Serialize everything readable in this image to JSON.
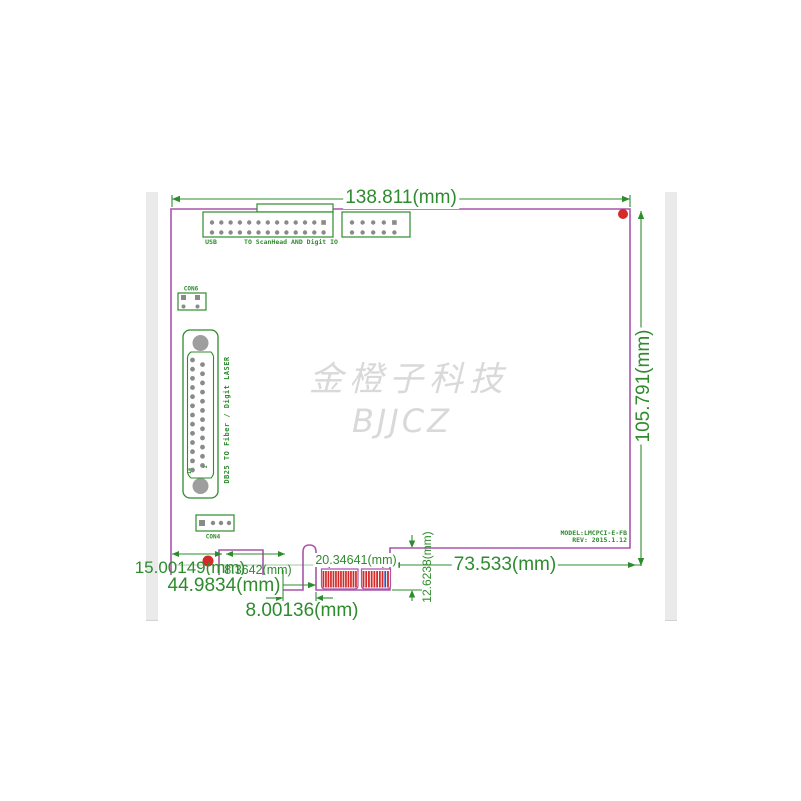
{
  "drawing": {
    "dimensions": {
      "board_width": "138.811(mm)",
      "board_height": "105.791(mm)",
      "bracket_offset": "15.00149(mm)",
      "notch_width": "8.3642(mm)",
      "edge_to_key": "44.9834(mm)",
      "key_width": "8.00136(mm)",
      "finger_span": "20.34641(mm)",
      "finger_height": "12.6238(mm)",
      "finger_to_edge": "73.533(mm)"
    },
    "labels": {
      "usb": "USB",
      "scanhead": "TO ScanHead AND Digit IO",
      "con6": "CON6",
      "con4": "CON4",
      "db25": "DB25  TO Fiber / Digit LASER",
      "model": "MODEL:LMCPCI-E-FB",
      "rev": "REV: 2015.1.12",
      "pin14": "14",
      "pin1": "1"
    },
    "watermark": {
      "line1": "金橙子科技",
      "line2": "BJJCZ"
    }
  },
  "connectors": {
    "usb_header": {
      "rows": 2,
      "pins_per_row": 13
    },
    "io_header": {
      "rows": 2,
      "pins_per_row": 5
    },
    "db25": {
      "pins_col1": 13,
      "pins_col2": 12
    },
    "con6": {
      "pins": 4
    },
    "con4": {
      "pins": 4
    },
    "edge_fingers": {
      "group1_stripes": 14,
      "group2_stripes": 10,
      "blue_stripe_index": 8
    }
  },
  "colors": {
    "outline": "#AA55AA",
    "annotation": "#2E8B2E",
    "finger": "#D42A2A",
    "finger_alt": "#3355BB",
    "pin": "#8A8A8A",
    "hole": "#9E9E9E",
    "marker": "#D42A2A",
    "watermark": "#D9D9D9"
  }
}
